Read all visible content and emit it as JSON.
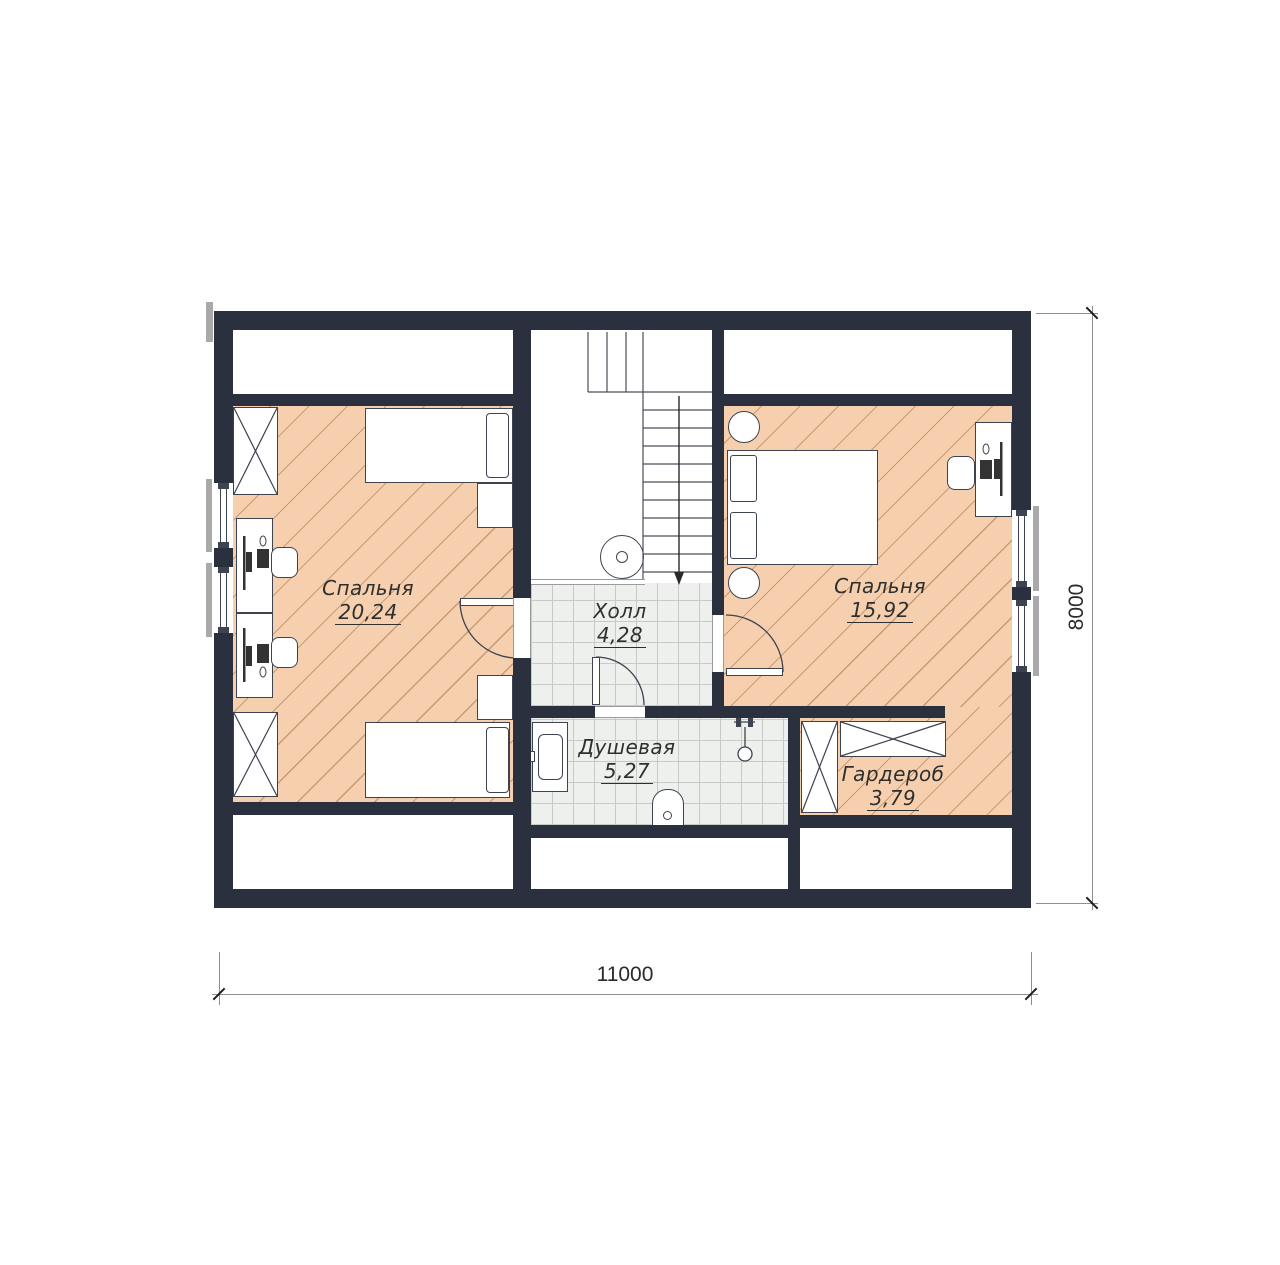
{
  "rooms": {
    "bedroom_left": {
      "name": "Спальня",
      "area": "20,24"
    },
    "hall": {
      "name": "Холл",
      "area": "4,28"
    },
    "bedroom_right": {
      "name": "Спальня",
      "area": "15,92"
    },
    "shower": {
      "name": "Душевая",
      "area": "5,27"
    },
    "wardrobe": {
      "name": "Гардероб",
      "area": "3,79"
    }
  },
  "dimensions": {
    "horizontal": "11000",
    "vertical": "8000"
  },
  "colors": {
    "wall": "#2a303e",
    "wood_floor": "#f6d0ae",
    "hatch_line": "#c89b74",
    "tile_floor": "#eef0ee",
    "tile_line": "#c7cbc7"
  }
}
